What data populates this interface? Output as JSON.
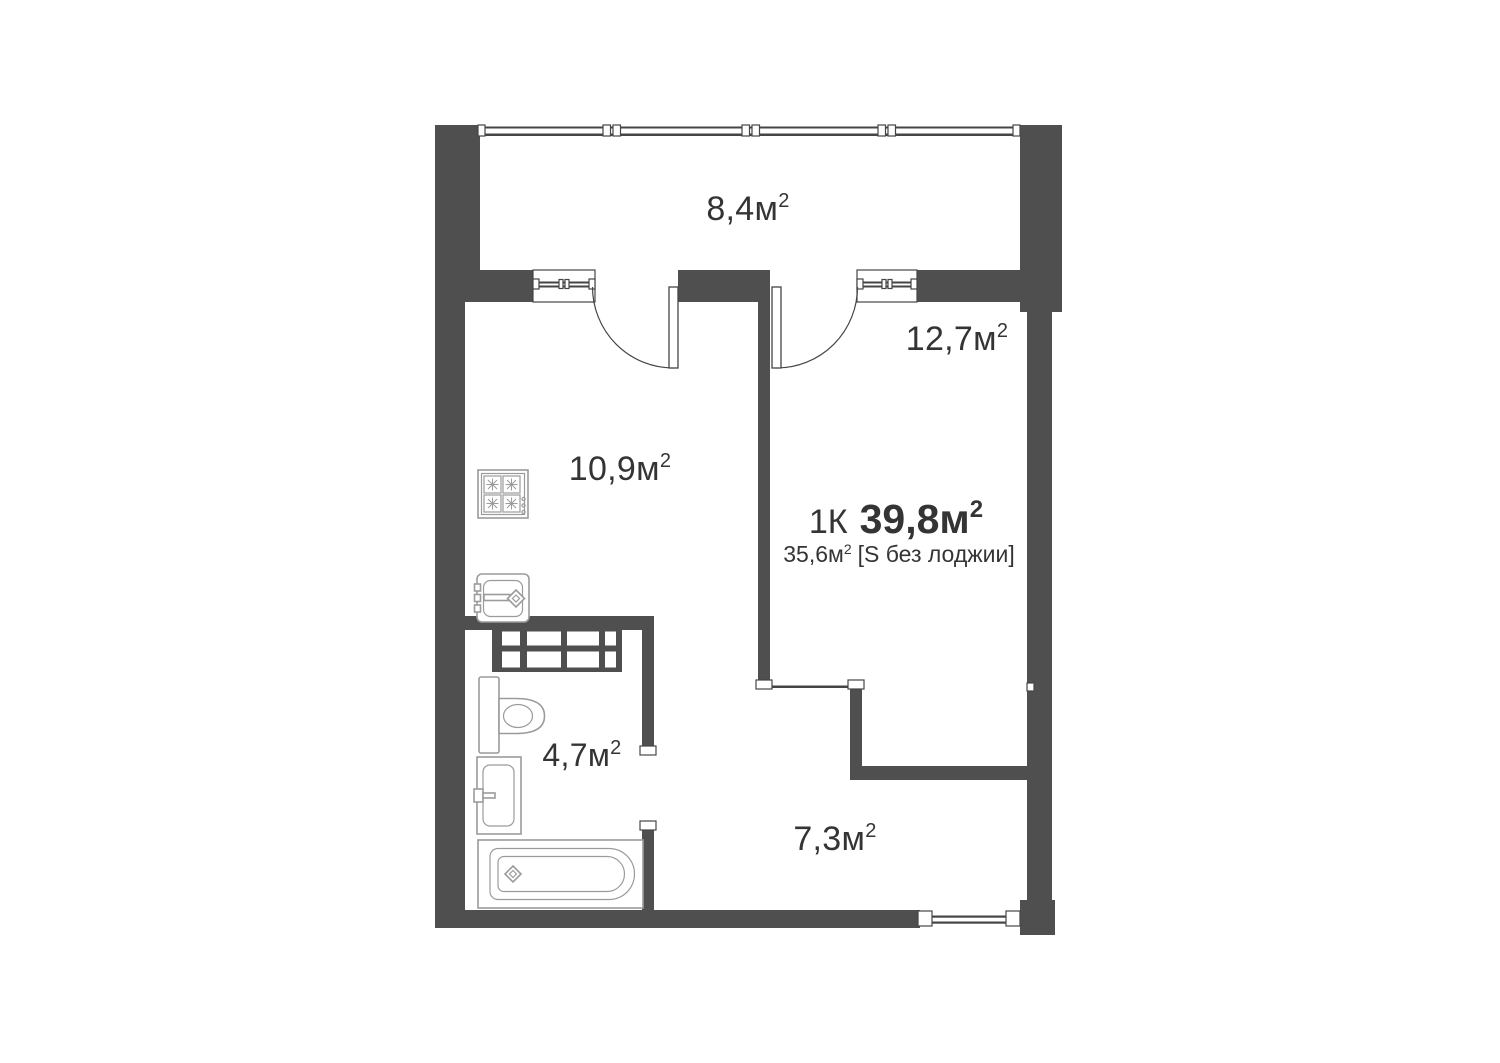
{
  "unit": {
    "type": "1К",
    "area": "39,8",
    "unit": "м",
    "sup": "2",
    "sub_value": "35,6",
    "sub_unit": "м",
    "sub_sup": "2",
    "sub_note": "[S без лоджии]"
  },
  "rooms": [
    {
      "id": "loggia",
      "value": "8,4",
      "unit": "м",
      "sup": "2"
    },
    {
      "id": "living-room",
      "value": "12,7",
      "unit": "м",
      "sup": "2"
    },
    {
      "id": "kitchen",
      "value": "10,9",
      "unit": "м",
      "sup": "2"
    },
    {
      "id": "bathroom",
      "value": "4,7",
      "unit": "м",
      "sup": "2"
    },
    {
      "id": "hallway",
      "value": "7,3",
      "unit": "м",
      "sup": "2"
    }
  ],
  "icons": [
    "stove-icon",
    "kitchen-sink-icon",
    "vent-shaft-icon",
    "toilet-icon",
    "bathroom-sink-icon",
    "bathtub-icon",
    "balcony-window-icon",
    "door-swing-icon",
    "entrance-door-icon"
  ],
  "colors": {
    "wall": "#4f4f4f",
    "line": "#454545",
    "fixture": "#9b9b9b",
    "text": "#343434",
    "background": "#ffffff"
  }
}
